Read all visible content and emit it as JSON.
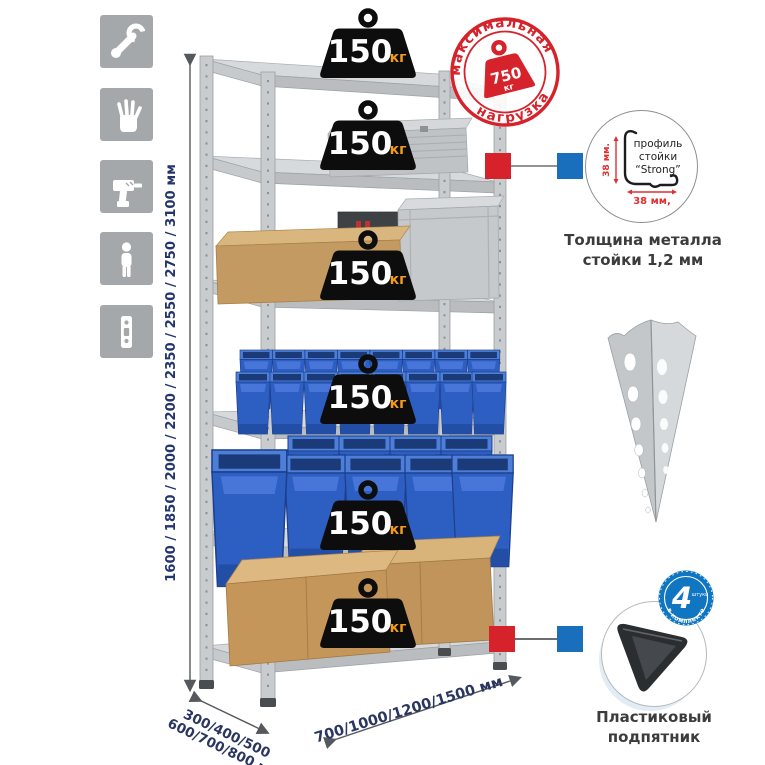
{
  "dimensions": {
    "height": "1600 / 1850 / 2000 / 2200 / 2350 / 2550 / 2750 / 3100 мм",
    "depth_line1": "300/400/500",
    "depth_line2": "600/700/800 мм",
    "width": "700/1000/1200/1500 мм"
  },
  "shelf_badge": {
    "value": "150",
    "unit": "кг",
    "count": 6
  },
  "max_load_stamp": {
    "text_top": "максимальная",
    "text_bottom": "нагрузка",
    "value": "750",
    "unit": "кг"
  },
  "profile_detail": {
    "line1": "профиль",
    "line2": "стойки",
    "line3": "“Strong”",
    "dim_vertical": "38 мм.",
    "dim_horizontal": "38 мм,",
    "caption_line1": "Толщина металла",
    "caption_line2": "стойки 1,2 мм"
  },
  "foot_detail": {
    "badge_value": "4",
    "badge_small": "штуки",
    "badge_arc": "в комплекте",
    "caption_line1": "Пластиковый",
    "caption_line2": "подпятник"
  },
  "colors": {
    "accent_red": "#d5222b",
    "accent_blue": "#1a6fbd",
    "bin_blue": "#2d5fc3",
    "dim_text": "#24356d"
  }
}
